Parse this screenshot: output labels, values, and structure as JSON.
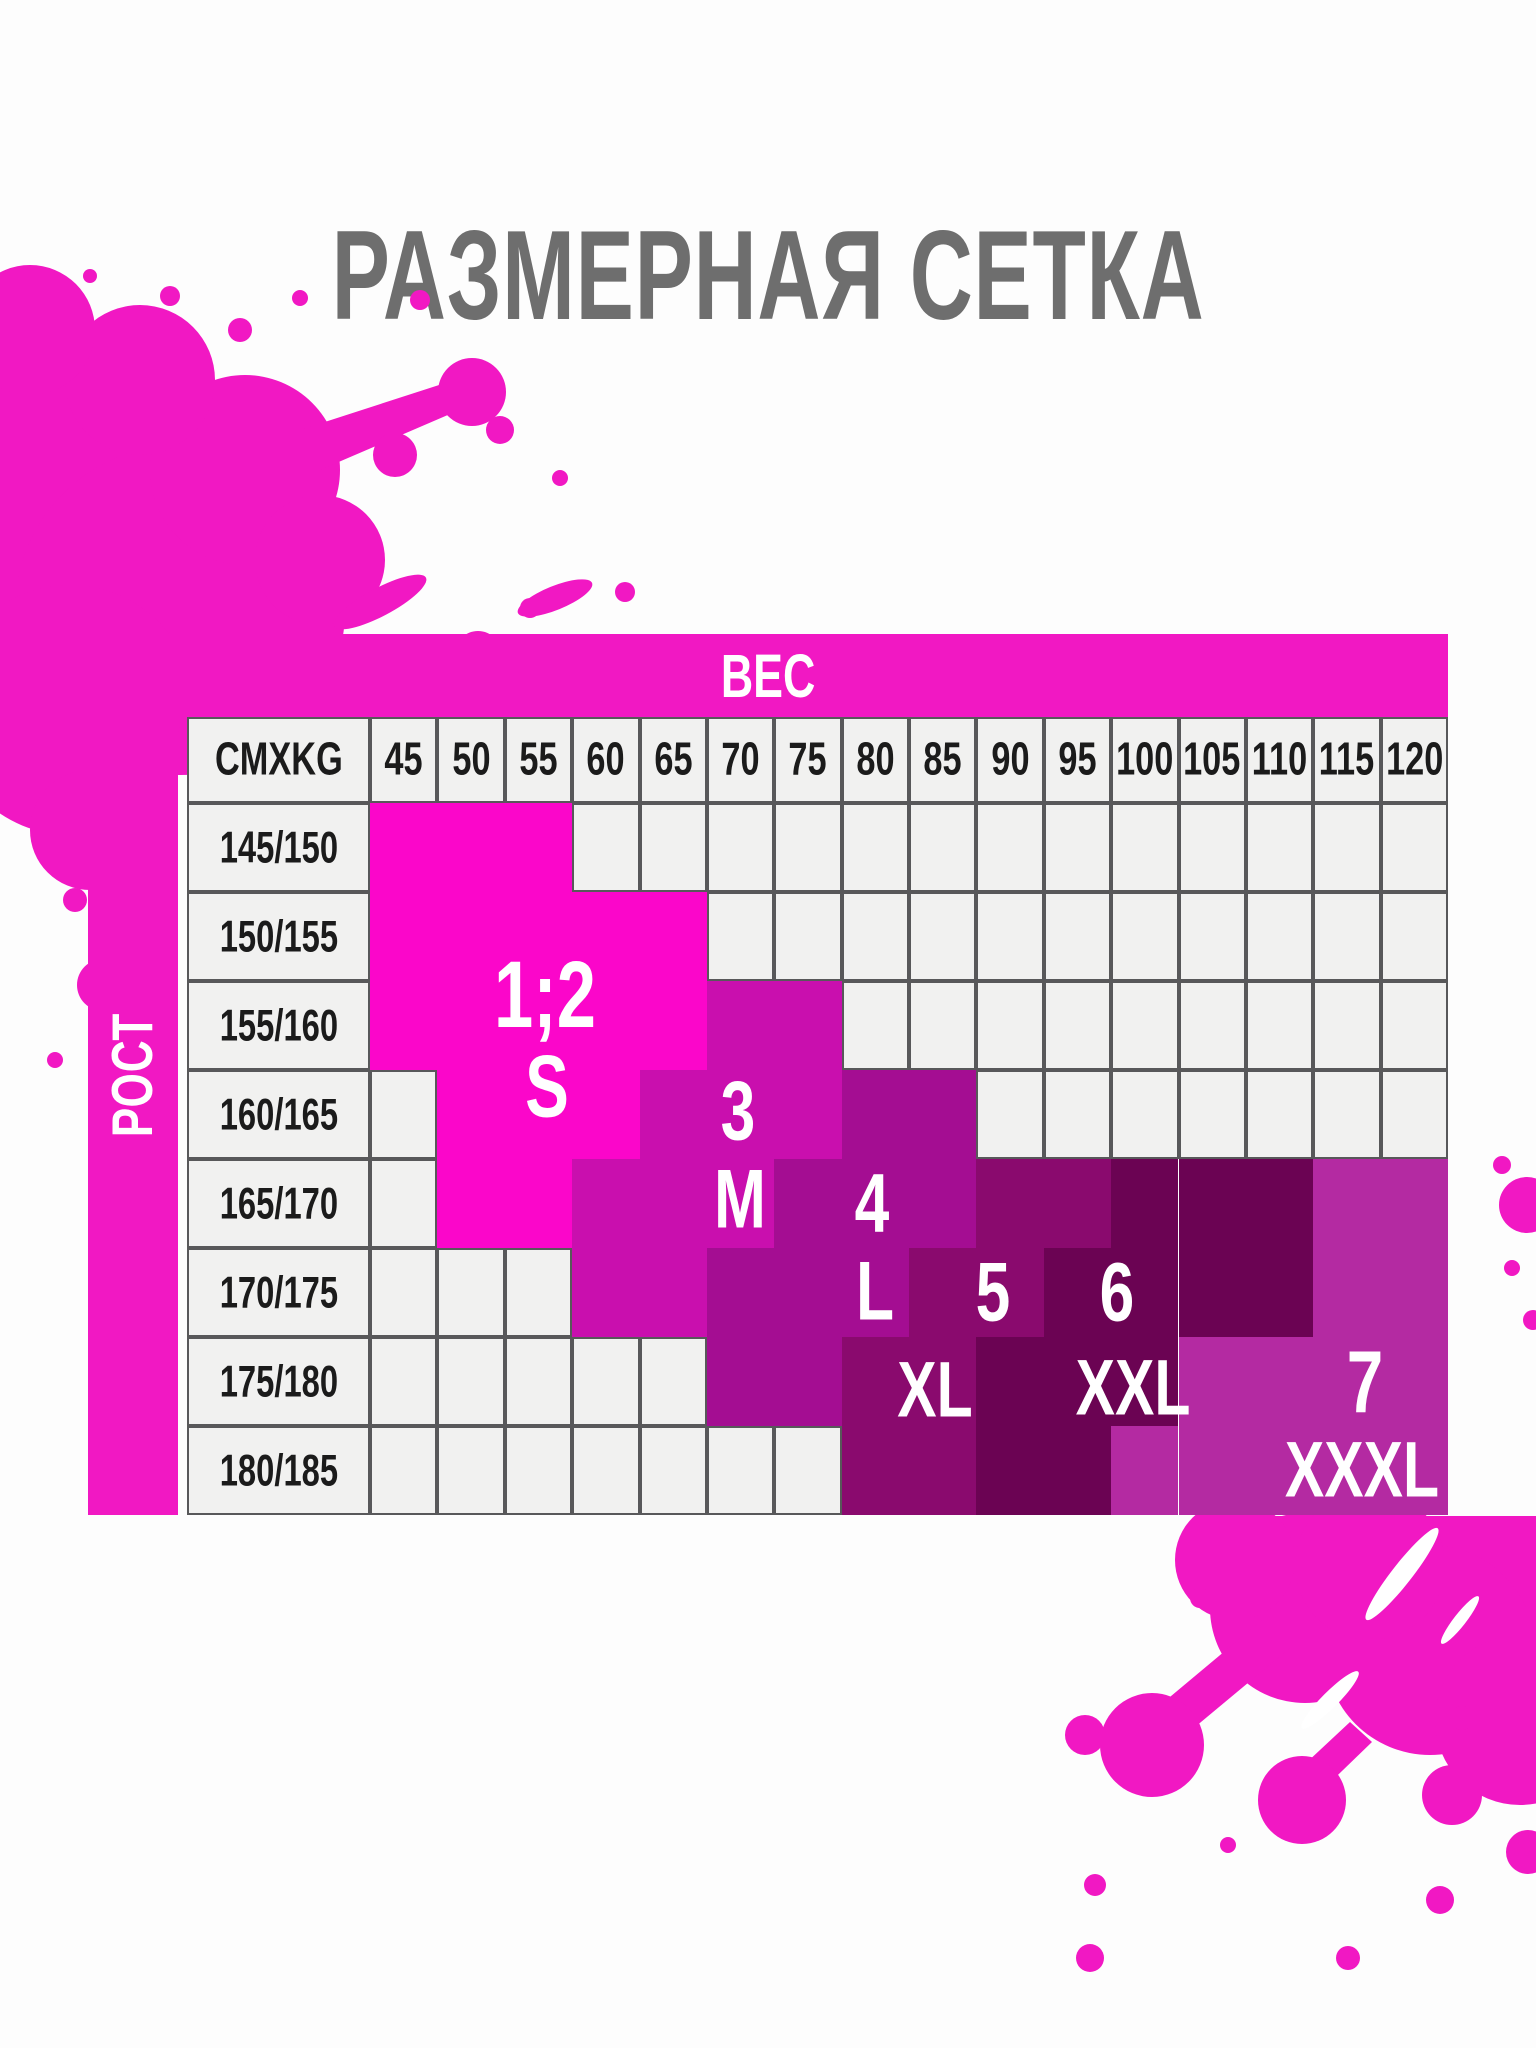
{
  "title": "РАЗМЕРНАЯ СЕТКА",
  "table": {
    "weight_axis_label": "ВЕС",
    "height_axis_label": "РОСТ",
    "corner_label": "CMXKG",
    "weights": [
      "45",
      "50",
      "55",
      "60",
      "65",
      "70",
      "75",
      "80",
      "85",
      "90",
      "95",
      "100",
      "105",
      "110",
      "115",
      "120"
    ],
    "heights": [
      "145/150",
      "150/155",
      "155/160",
      "160/165",
      "165/170",
      "170/175",
      "175/180",
      "180/185"
    ]
  },
  "sizes": [
    {
      "code": "S",
      "number_label": "1;2",
      "size_label": "S",
      "color": "#fb06ca"
    },
    {
      "code": "M",
      "number_label": "3",
      "size_label": "M",
      "color": "#c90fae"
    },
    {
      "code": "L",
      "number_label": "4",
      "size_label": "L",
      "color": "#a40d92"
    },
    {
      "code": "F",
      "number_label": "5",
      "size_label": "XL",
      "color": "#8a0a6e"
    },
    {
      "code": "X",
      "number_label": "6",
      "size_label": "XXL",
      "color": "#6b0353"
    },
    {
      "code": "V",
      "number_label": "7",
      "size_label": "XXXL",
      "color": "#b42aa2"
    }
  ],
  "chart_data": {
    "type": "table",
    "title": "РАЗМЕРНАЯ СЕТКА",
    "x_axis": {
      "label": "ВЕС",
      "unit": "kg",
      "ticks": [
        45,
        50,
        55,
        60,
        65,
        70,
        75,
        80,
        85,
        90,
        95,
        100,
        105,
        110,
        115,
        120
      ]
    },
    "y_axis": {
      "label": "РОСТ",
      "unit": "cm",
      "ticks": [
        "145/150",
        "150/155",
        "155/160",
        "160/165",
        "165/170",
        "170/175",
        "175/180",
        "180/185"
      ]
    },
    "corner": "CMXKG",
    "legend": {
      "S": "1;2 / S",
      "M": "3 / M",
      "L": "4 / L",
      "F": "5 / XL",
      "X": "6 / XXL",
      "V": "7 / XXXL",
      "G": "empty"
    },
    "grid_rows": [
      "SSSGGGGGGGGGGGGG",
      "SSSSSGGGGGGGGGGG",
      "SSSSSMMGGGGGGGGG",
      "GSSSMMMLLGGGGGGG",
      "GSSMMMLLLFFXXXVV",
      "GGGMMLLLFFXXXXVV",
      "GGGGGLLFFXXXVVVV",
      "GGGGGGGFFXXVVVVV"
    ]
  },
  "overlays": [
    {
      "text": "1;2",
      "x": 545,
      "y": 995,
      "fs": 86
    },
    {
      "text": "S",
      "x": 547,
      "y": 1087,
      "fs": 80
    },
    {
      "text": "3",
      "x": 738,
      "y": 1112,
      "fs": 76
    },
    {
      "text": "M",
      "x": 740,
      "y": 1200,
      "fs": 76
    },
    {
      "text": "4",
      "x": 872,
      "y": 1204,
      "fs": 76
    },
    {
      "text": "L",
      "x": 875,
      "y": 1292,
      "fs": 76
    },
    {
      "text": "5",
      "x": 993,
      "y": 1293,
      "fs": 76
    },
    {
      "text": "6",
      "x": 1117,
      "y": 1293,
      "fs": 76
    },
    {
      "text": "XL",
      "x": 935,
      "y": 1390,
      "fs": 72
    },
    {
      "text": "XXL",
      "x": 1133,
      "y": 1388,
      "fs": 72
    },
    {
      "text": "7",
      "x": 1365,
      "y": 1383,
      "fs": 80
    },
    {
      "text": "XXXL",
      "x": 1362,
      "y": 1470,
      "fs": 72
    }
  ],
  "colors": {
    "accent_magenta": "#f118c3",
    "empty_cell": "#f1f1f0",
    "grid_border": "#58585a",
    "title_gray": "#6e6e6e",
    "cell_text": "#1b1b1b",
    "label_text": "#ffffff"
  }
}
